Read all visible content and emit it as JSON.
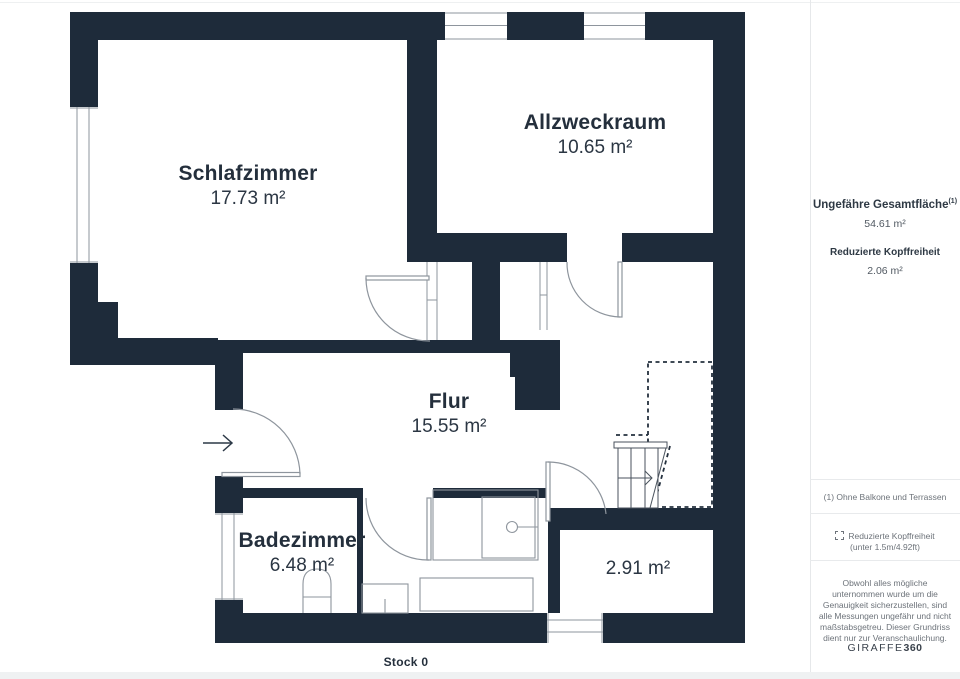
{
  "plan": {
    "floor_label": "Stock 0",
    "rooms": {
      "schlafzimmer": {
        "name": "Schlafzimmer",
        "area": "17.73 m²"
      },
      "allzweckraum": {
        "name": "Allzweckraum",
        "area": "10.65 m²"
      },
      "flur": {
        "name": "Flur",
        "area": "15.55 m²"
      },
      "badezimmer": {
        "name": "Badezimmer",
        "area": "6.48 m²"
      },
      "room_291": {
        "area": "2.91 m²"
      }
    }
  },
  "sidebar": {
    "total_area_label": "Ungefähre Gesamtfläche",
    "total_area_footnote": "(1)",
    "total_area_value": "54.61 m²",
    "reduced_headroom_label": "Reduzierte Kopffreiheit",
    "reduced_headroom_value": "2.06 m²",
    "footnote": "(1) Ohne Balkone und Terrassen",
    "legend_reduced_label": "Reduzierte Kopffreiheit",
    "legend_reduced_sub": "(unter 1.5m/4.92ft)",
    "disclaimer": "Obwohl alles mögliche unternommen wurde um die Genauigkeit sicherzustellen, sind alle Messungen ungefähr und nicht maßstabsgetreu. Dieser Grundriss dient nur zur Veranschaulichung.",
    "brand_name": "GIRAFFE",
    "brand_suffix": "360"
  },
  "colors": {
    "wall": "#1e2b3a",
    "thin_line": "#8e959d",
    "stair_line": "#49525c",
    "label": "#242f3c"
  }
}
